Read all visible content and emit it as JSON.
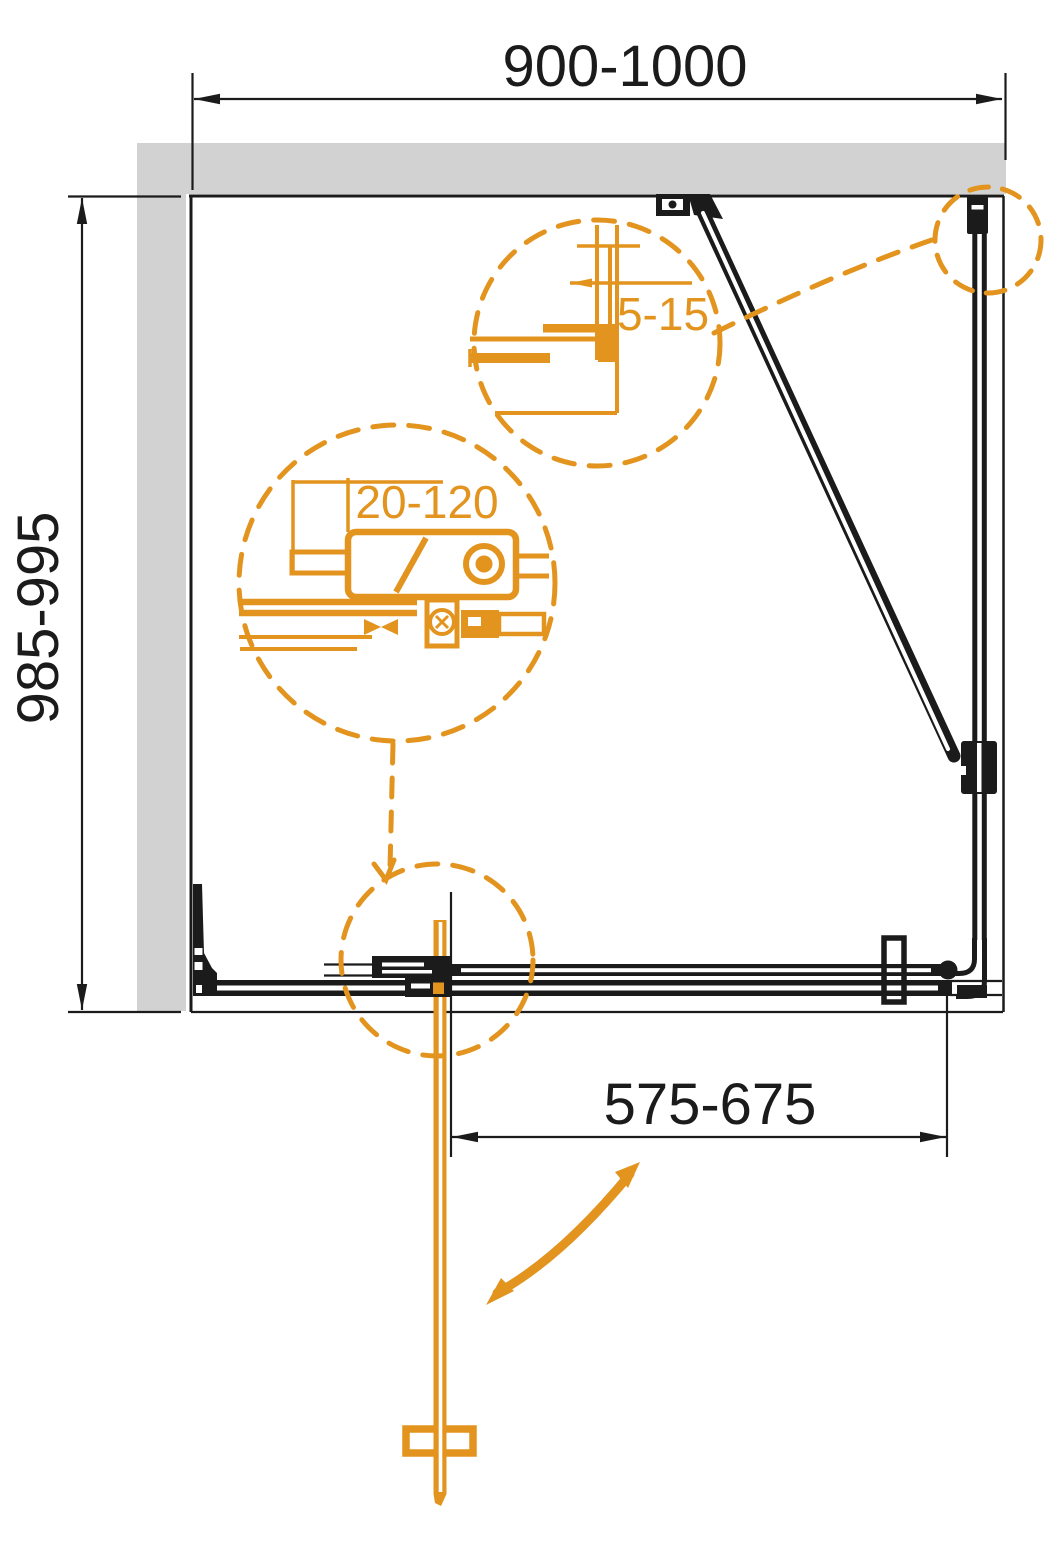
{
  "drawing": {
    "kind": "shower-enclosure-installation-diagram",
    "dimensions": {
      "overall_width": "900-1000",
      "overall_depth": "985-995",
      "door_width": "575-675",
      "wall_profile_range": "5-15",
      "adjustment_range": "20-120"
    },
    "colors": {
      "accent_orange": "#E2941E",
      "wall_gray": "#D2D2D2",
      "line_black": "#1B1B1B",
      "background": "#FFFFFF"
    }
  }
}
